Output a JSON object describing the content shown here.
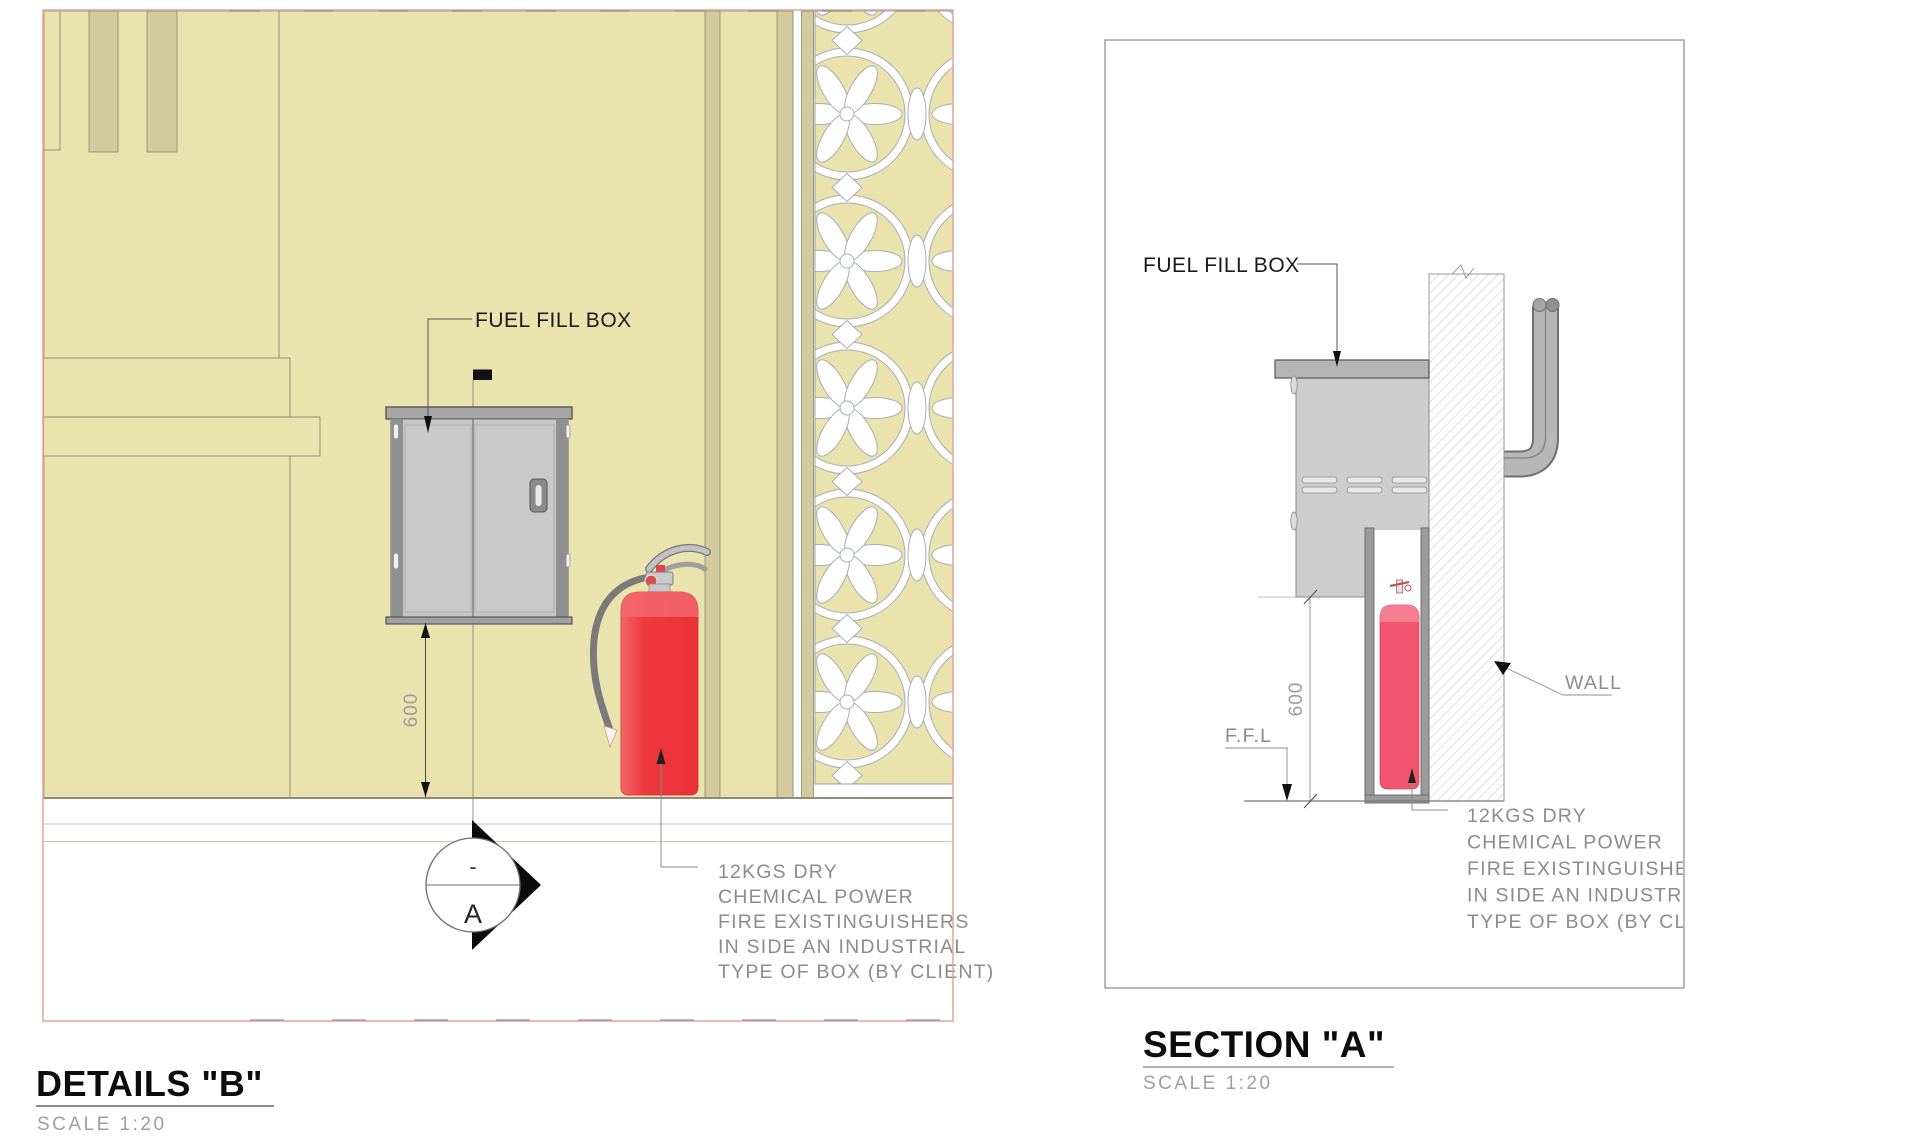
{
  "drawings": {
    "details_b": {
      "title": "DETAILS \"B\"",
      "scale_label": "SCALE 1:20",
      "labels": {
        "fuel_fill_box": "FUEL FILL BOX",
        "dim_600": "600",
        "section_marker_top": "-",
        "section_marker_letter": "A"
      },
      "note_lines": [
        "12KGS DRY",
        "CHEMICAL POWER",
        "FIRE EXISTINGUISHERS",
        "IN SIDE AN INDUSTRIAL",
        "TYPE OF BOX (BY CLIENT)"
      ]
    },
    "section_a": {
      "title": "SECTION \"A\"",
      "scale_label": "SCALE 1:20",
      "labels": {
        "fuel_fill_box": "FUEL FILL BOX",
        "wall": "WALL",
        "ffl": "F.F.L",
        "dim_600": "600"
      },
      "note_lines": [
        "12KGS DRY",
        "CHEMICAL POWER",
        "FIRE EXISTINGUISHERS",
        "IN SIDE AN INDUSTRIAL",
        "TYPE OF BOX (BY CLIENT)"
      ]
    }
  },
  "colors": {
    "wall_beige": "#ebe3ae",
    "stripe_tan": "#d3cb9e",
    "border_salmon": "#dfa49b",
    "cabinet_gray": "#c6c6c6",
    "cabinet_cap_gray": "#a6a6a6",
    "extinguisher_red": "#ee3a3f",
    "extinguisher_pink": "#f2566e",
    "cad_text_gray": "#8c8c8c",
    "pattern_outline": "#a7adb5"
  }
}
